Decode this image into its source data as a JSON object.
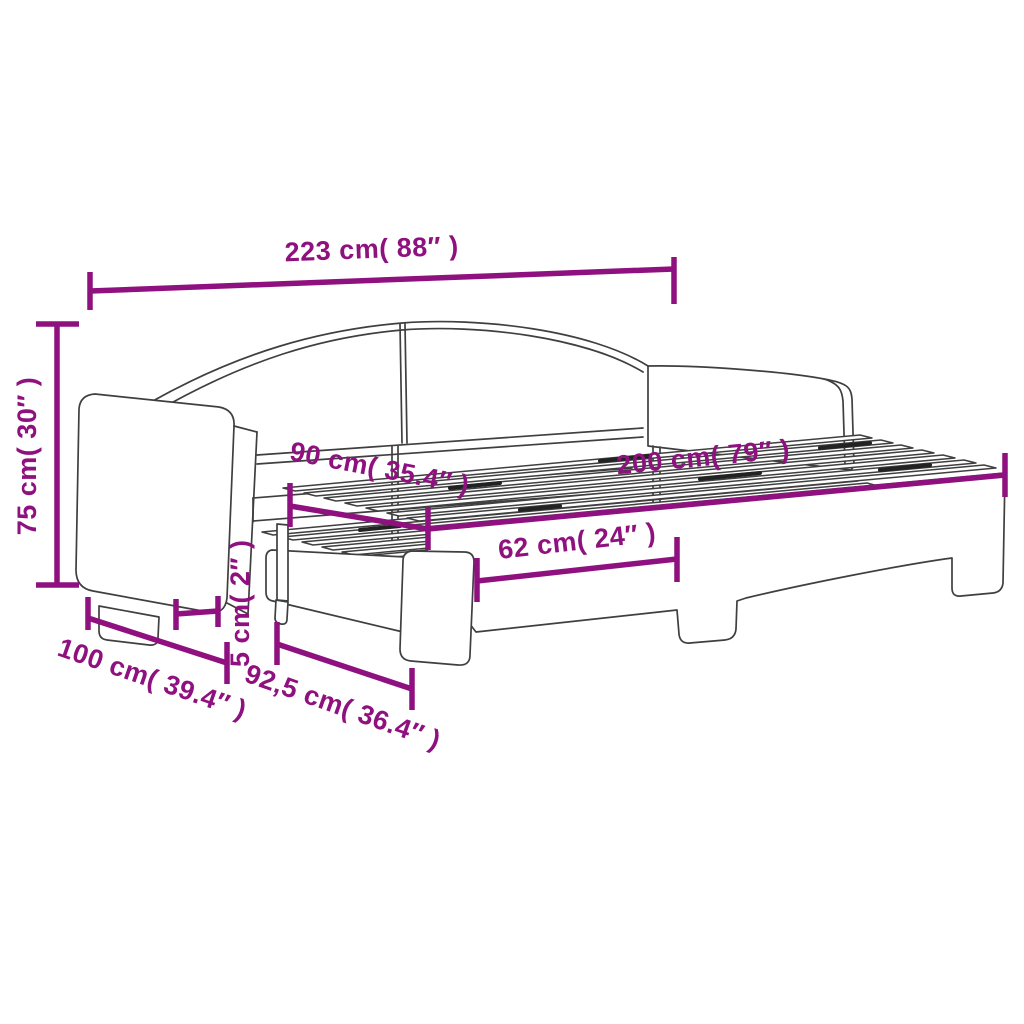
{
  "diagram": {
    "title": "daybed-with-pull-out-trundle-dimension-diagram",
    "accent_color": "#8F117F",
    "line_color": "#3F3F3F",
    "background": "#FFFFFF"
  },
  "dimensions": {
    "overall_length": "223 cm( 88″ )",
    "overall_height": "75 cm( 30″ )",
    "mattress_width": "90 cm( 35.4″ )",
    "mattress_length": "200 cm( 79″ )",
    "front_rail_length": "62 cm( 24″ )",
    "clearance": "5 cm( 2″ )",
    "overall_depth": "100 cm( 39.4″ )",
    "trundle_width": "92,5 cm( 36.4″ )"
  }
}
